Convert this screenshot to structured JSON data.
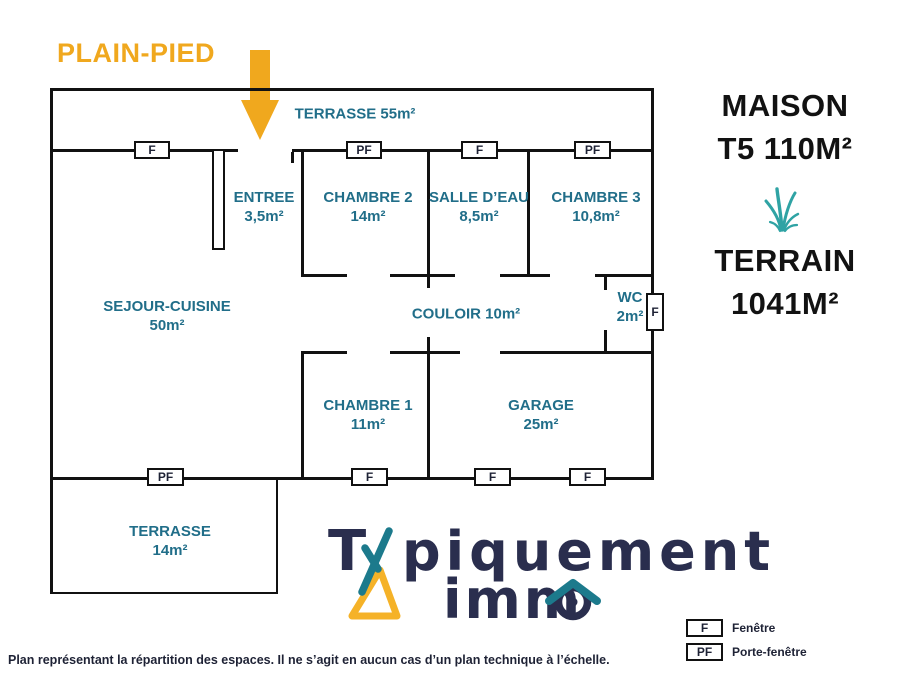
{
  "page": {
    "floor_label": "PLAIN-PIED",
    "disclaimer": "Plan représentant la répartition des espaces. Il ne s’agit en aucun cas d’un plan technique à l’échelle."
  },
  "plan": {
    "rooms": {
      "terrasse_top": {
        "label": "TERRASSE 55m²"
      },
      "entree": {
        "name": "ENTREE",
        "area": "3,5m²"
      },
      "chambre2": {
        "name": "CHAMBRE 2",
        "area": "14m²"
      },
      "salle_eau": {
        "name": "SALLE D’EAU",
        "area": "8,5m²"
      },
      "chambre3": {
        "name": "CHAMBRE 3",
        "area": "10,8m²"
      },
      "sejour": {
        "name": "SEJOUR-CUISINE",
        "area": "50m²"
      },
      "couloir": {
        "label": "COULOIR 10m²"
      },
      "wc": {
        "name": "WC",
        "area": "2m²"
      },
      "chambre1": {
        "name": "CHAMBRE 1",
        "area": "11m²"
      },
      "garage": {
        "name": "GARAGE",
        "area": "25m²"
      },
      "terrasse_bottom": {
        "name": "TERRASSE",
        "area": "14m²"
      }
    },
    "windows": {
      "top_sejour": "F",
      "top_chambre2": "PF",
      "top_salle_eau": "F",
      "top_chambre3": "PF",
      "bottom_terrasse": "PF",
      "bottom_chambre1": "F",
      "bottom_garage_left": "F",
      "bottom_garage_right": "F",
      "wc_right": "F"
    }
  },
  "info_panel": {
    "maison_line1": "MAISON",
    "maison_line2": "T5 110M²",
    "terrain_line1": "TERRAIN",
    "terrain_line2": "1041M²"
  },
  "logo": {
    "full_name": "Typiquement immo",
    "word1_initial": "T",
    "word1_rest": "piquement",
    "word2_rest": "imm"
  },
  "legend": {
    "items": [
      {
        "symbol": "F",
        "label": "Fenêtre"
      },
      {
        "symbol": "PF",
        "label": "Porte-fenêtre"
      }
    ]
  },
  "colors": {
    "accent_orange": "#F0A81E",
    "room_label_teal": "#216E89",
    "logo_navy": "#2A2E4E",
    "logo_teal": "#1C7A8C",
    "logo_triangle_orange": "#F5B228",
    "grass_teal": "#2FA3A4"
  }
}
